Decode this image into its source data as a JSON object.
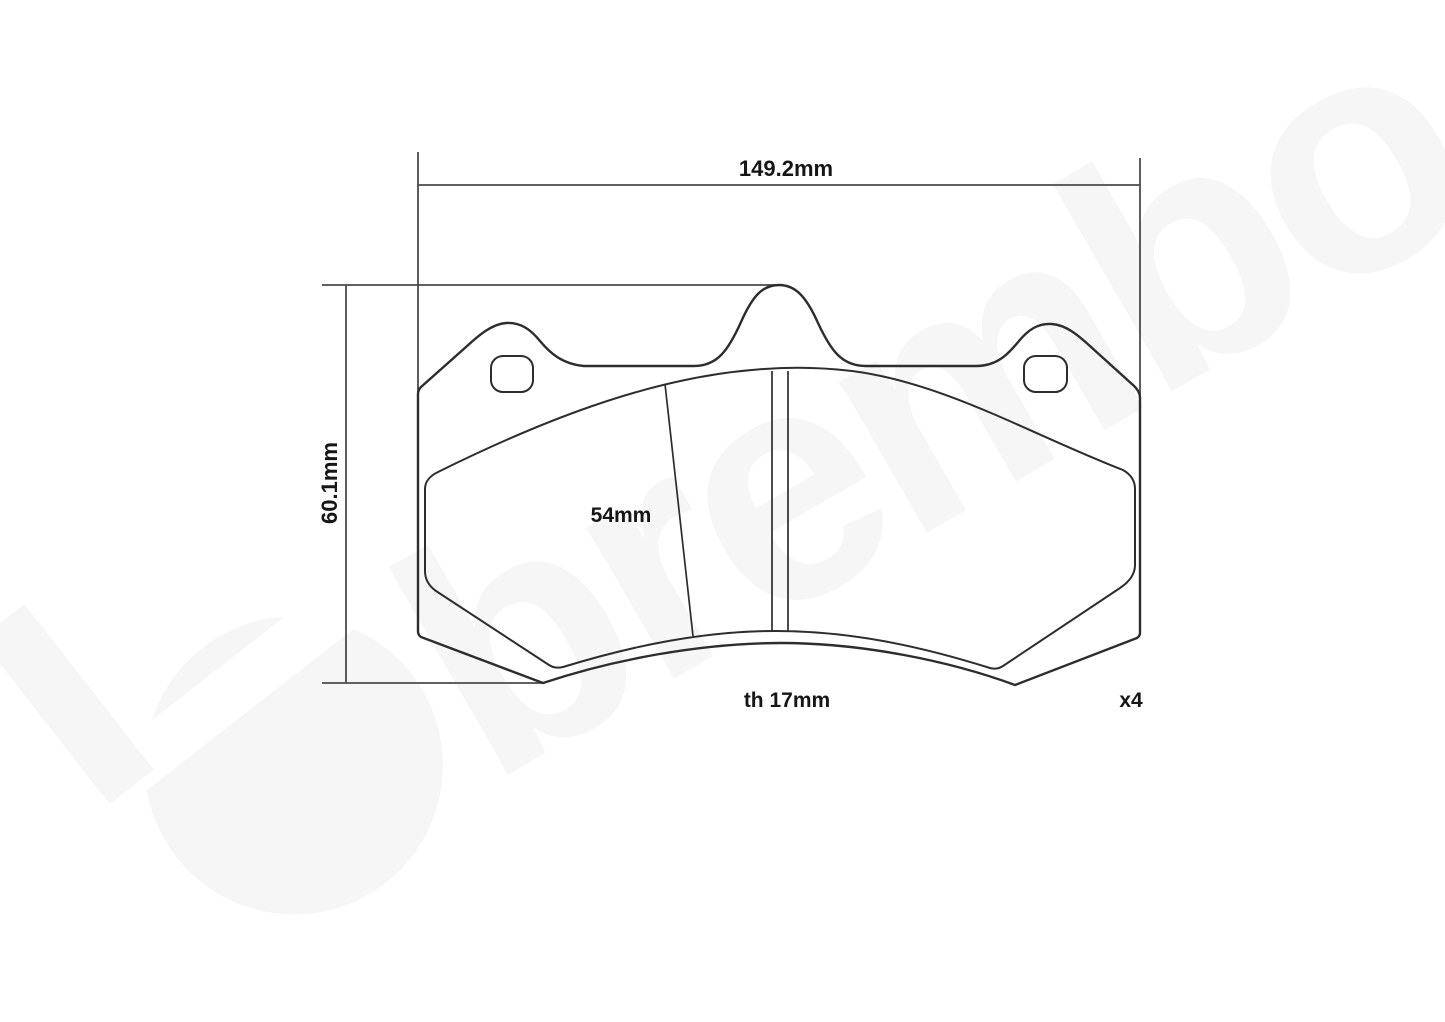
{
  "drawing": {
    "labels": {
      "width": "149.2mm",
      "height": "60.1mm",
      "pad_height": "54mm",
      "thickness": "th 17mm",
      "quantity": "x4"
    },
    "watermark": {
      "brand": "brembo",
      "color": "#f6f6f6"
    },
    "colors": {
      "background": "#ffffff",
      "part_line": "#2d2d2d",
      "dimension_line": "#4a4a4a",
      "text": "#161616"
    }
  }
}
